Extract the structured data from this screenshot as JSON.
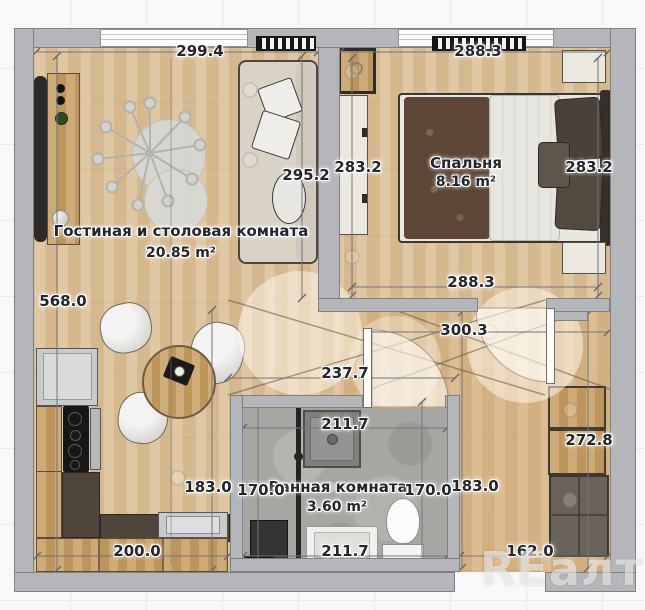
{
  "watermark": "REалт",
  "rooms": {
    "living": {
      "name": "Гостиная и столовая комната",
      "area": "20.85 m²"
    },
    "bedroom": {
      "name": "Спальня",
      "area": "8.16 m²"
    },
    "bathroom": {
      "name": "Ванная комната",
      "area": "3.60 m²"
    }
  },
  "dimensions": {
    "living_top": "299.4",
    "bedroom_top": "288.3",
    "living_right": "295.2",
    "bedroom_left": "283.2",
    "bedroom_right": "283.2",
    "left_total": "568.0",
    "bedroom_bottom": "288.3",
    "hall_top": "300.3",
    "hall_mid": "237.7",
    "bath_top": "211.7",
    "kitchen_right": "183.0",
    "bath_left": "170.0",
    "bath_right": "170.0",
    "hall_right": "183.0",
    "closet_right": "272.8",
    "kitchen_bottom": "200.0",
    "bath_bottom": "211.7",
    "entry_bottom": "162.0"
  }
}
